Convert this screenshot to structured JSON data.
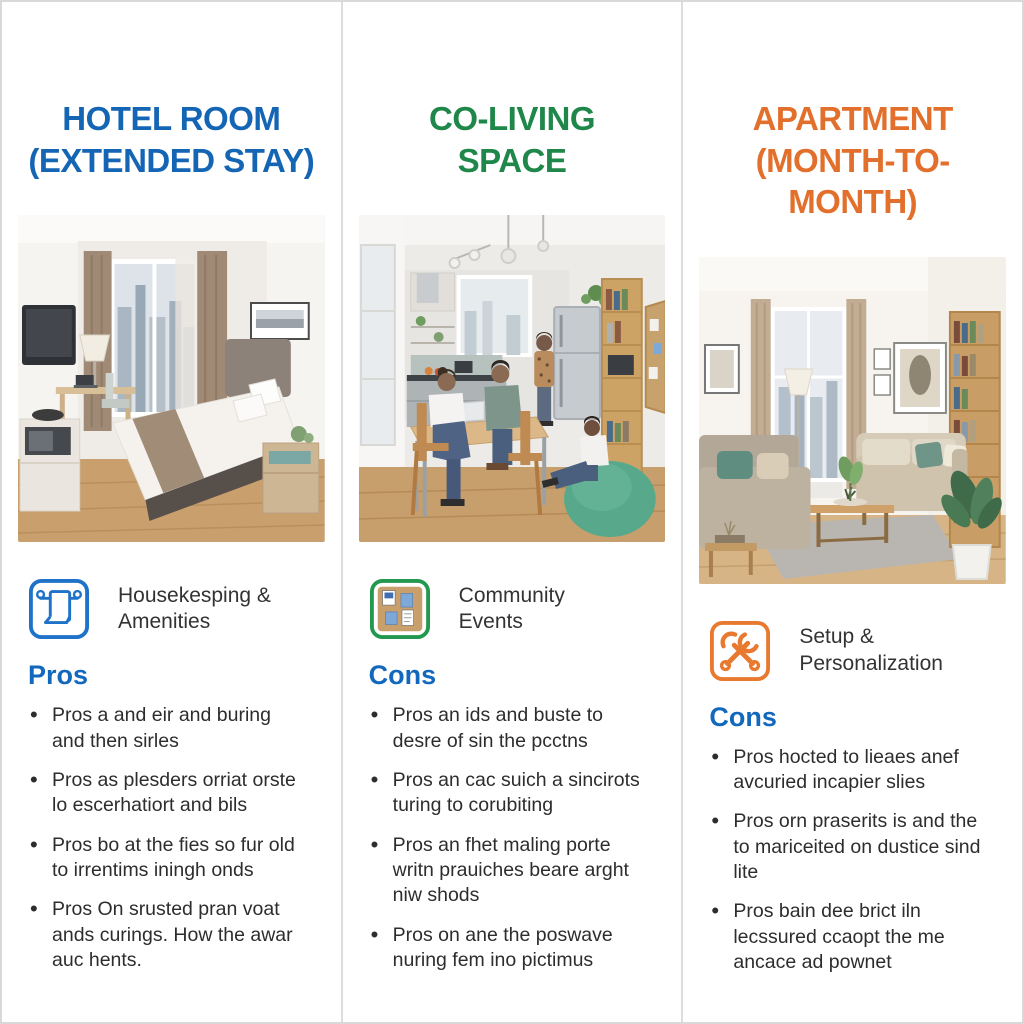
{
  "colors": {
    "hotel_accent": "#1565b5",
    "coliving_accent": "#1e8749",
    "apartment_accent": "#e2702c",
    "list_heading_blue": "#1268bd",
    "body_text": "#2d2d2d",
    "divider": "#dcdcdc"
  },
  "columns": [
    {
      "title_line1": "HOTEL ROOM",
      "title_line2": "(EXTENDED STAY)",
      "photo": "hotel-room-photo",
      "feature_icon": "towel-icon",
      "feature_label": "Housekesping & Amenities",
      "list_heading": "Pros",
      "bullets": [
        "Pros a and eir and buring and then sirles",
        "Pros as plesders orriat orste lo escerhatiort and bils",
        "Pros bo at the fies so fur old to irrentims iningh onds",
        "Pros On srusted pran voat ands curings. How the awar auc hents."
      ]
    },
    {
      "title_line1": "CO-LIVING",
      "title_line2": "SPACE",
      "photo": "coliving-space-photo",
      "feature_icon": "corkboard-icon",
      "feature_label": "Community Events",
      "list_heading": "Cons",
      "bullets": [
        "Pros an ids and buste to desre of sin the pcctns",
        "Pros an cac suich a sincirots turing to corubiting",
        "Pros an fhet maling porte writn prauiches beare arght niw shods",
        "Pros on ane the poswave nuring fem ino pictimus"
      ]
    },
    {
      "title_line1": "APARTMENT",
      "title_line2": "(MONTH-TO-MONTH)",
      "photo": "apartment-photo",
      "feature_icon": "tools-icon",
      "feature_label": "Setup & Personalization",
      "list_heading": "Cons",
      "bullets": [
        "Pros hocted to lieaes anef avcuried incapier slies",
        "Pros orn praserits is and the to mariceited on dustice sind lite",
        "Pros bain dee brict iln lecssured ccaopt the me ancace ad pownet"
      ]
    }
  ]
}
